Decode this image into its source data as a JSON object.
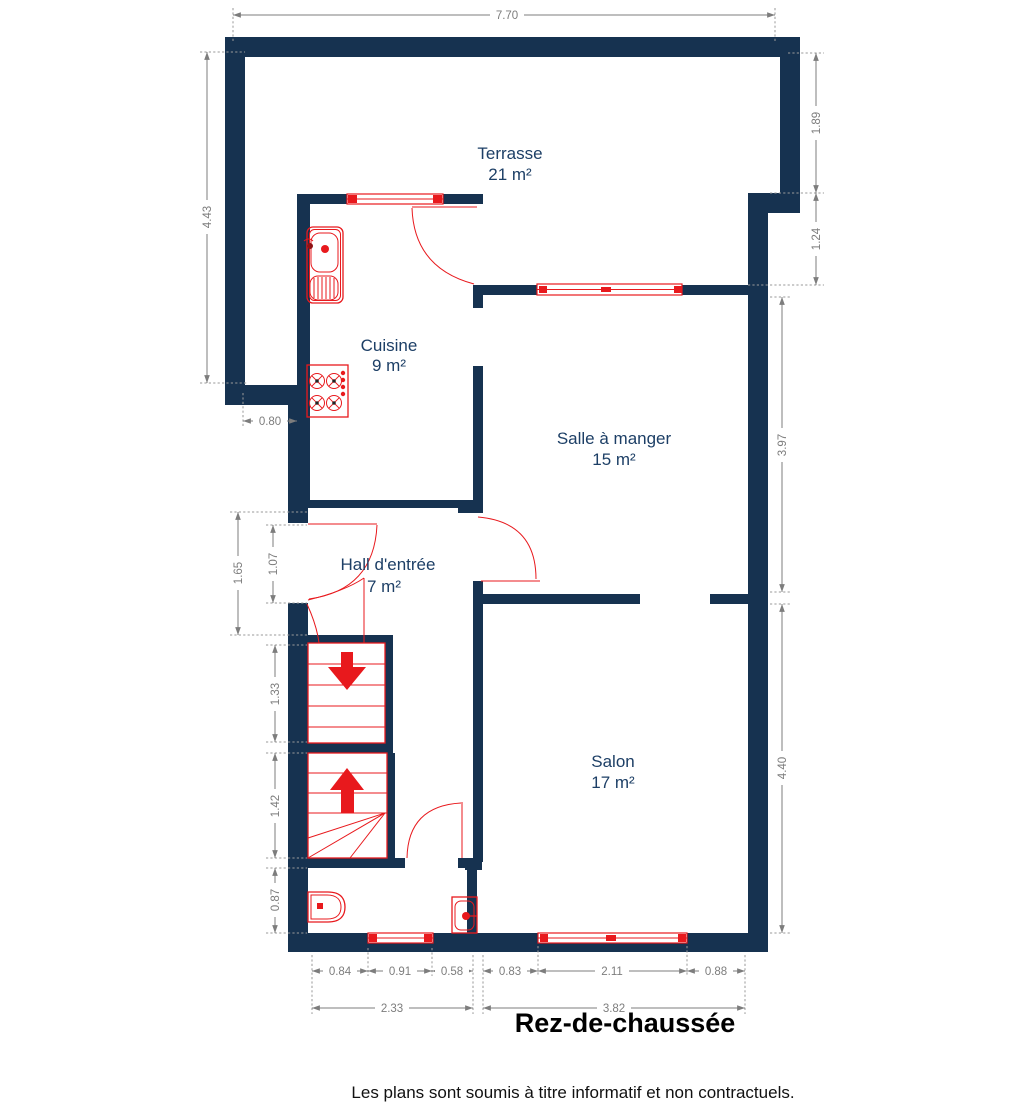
{
  "title": "Rez-de-chaussée",
  "footer": "Les plans sont soumis à titre informatif et non contractuels.",
  "colors": {
    "wall": "#163250",
    "fixtures_and_openings": "#e8191d",
    "dimension_lines": "#7d7d7d",
    "room_labels": "#1d3f66",
    "title_text": "#000000"
  },
  "rooms": {
    "terrasse": {
      "name": "Terrasse",
      "area": "21 m²"
    },
    "cuisine": {
      "name": "Cuisine",
      "area": "9 m²"
    },
    "salle_a_manger": {
      "name": "Salle à manger",
      "area": "15 m²"
    },
    "hall": {
      "name": "Hall d'entrée",
      "area": "7 m²"
    },
    "salon": {
      "name": "Salon",
      "area": "17 m²"
    }
  },
  "dimensions": {
    "top_width": "7.70",
    "right_upper": "1.89",
    "right_step": "1.24",
    "right_dining": "3.97",
    "right_salon": "4.40",
    "left_terrace": "4.43",
    "kitchen_offset": "0.80",
    "left_hall": "1.65",
    "left_front_door": "1.07",
    "left_stairs_down": "1.33",
    "left_stairs_up": "1.42",
    "left_wc": "0.87",
    "bottom_wc_left": "0.84",
    "bottom_wc_window": "0.91",
    "bottom_wc_right": "0.58",
    "bottom_salon_left": "0.83",
    "bottom_salon_window": "2.11",
    "bottom_salon_right": "0.88",
    "bottom_total_left": "2.33",
    "bottom_total_right": "3.82"
  }
}
